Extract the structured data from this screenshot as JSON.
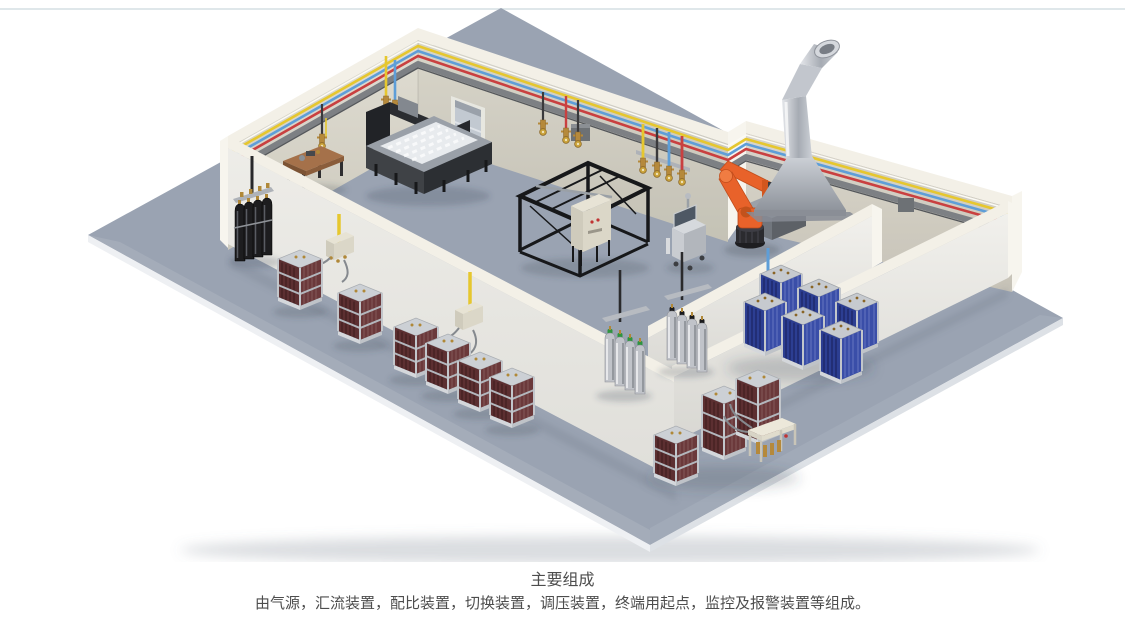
{
  "page": {
    "background": "#ffffff",
    "top_divider_color": "#dfe7ea"
  },
  "caption": {
    "title": "主要组成",
    "description": "由气源，汇流装置，配比装置，切换装置，调压装置，终端用起点，监控及报警装置等组成。",
    "text_color": "#4d4d4d"
  },
  "scene": {
    "floor_color": "#9aa3b2",
    "floor_edge_color": "#eef0f3",
    "wall_interior_color": "#d9d6c9",
    "wall_trim_color": "#f3f0e7",
    "wall_exterior_color": "#e9e8e3",
    "wall_end_color": "#f7f5ee",
    "pipe_yellow": "#e6c72e",
    "pipe_blue": "#5e9ed8",
    "pipe_red": "#c94040",
    "pipe_tray": "#7d8084",
    "robot_orange": "#e8622a",
    "duct_silver": "#c2c6cd",
    "hood_gray": "#a9aeb6",
    "cylinder_maroon": "#5c2f31",
    "cylinder_blue": "#2c3e92",
    "cylinder_black": "#1d1d1f",
    "cylinder_silver": "#c0c3c9",
    "cap_green": "#2f9440",
    "brass": "#b5893b",
    "machine_dark": "#2c2f33",
    "table_wood": "#a5714a"
  }
}
